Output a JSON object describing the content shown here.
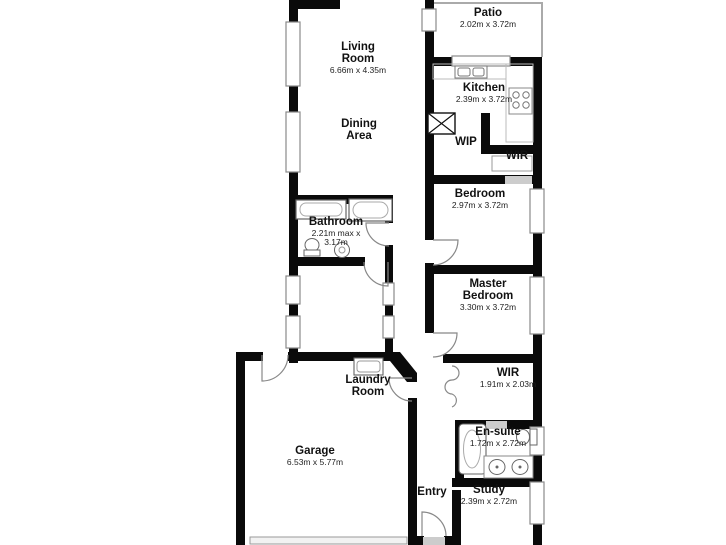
{
  "plan": {
    "type": "floor-plan",
    "wall_color": "#000000",
    "window_frame_color": "#8a8a8a",
    "opening_color": "#cccccc",
    "fixture_line_color": "#777777",
    "background_color": "#ffffff",
    "rooms": [
      {
        "name": "Living Room",
        "dims": "6.66m x 4.35m"
      },
      {
        "name": "Patio",
        "dims": "2.02m x 3.72m"
      },
      {
        "name": "Kitchen",
        "dims": "2.39m x 3.72m"
      },
      {
        "name": "Dining Area",
        "dims": ""
      },
      {
        "name": "WIP",
        "dims": ""
      },
      {
        "name": "WIR",
        "dims": ""
      },
      {
        "name": "Bedroom",
        "dims": "2.97m x 3.72m"
      },
      {
        "name": "Bathroom",
        "dims": "2.21m max x 3.17m"
      },
      {
        "name": "Master Bedroom",
        "dims": "3.30m x 3.72m"
      },
      {
        "name": "WIR",
        "dims": "1.91m x 2.03m"
      },
      {
        "name": "Laundry Room",
        "dims": ""
      },
      {
        "name": "Garage",
        "dims": "6.53m x 5.77m"
      },
      {
        "name": "Entry",
        "dims": ""
      },
      {
        "name": "En-suite",
        "dims": "1.72m x 2.72m"
      },
      {
        "name": "Study",
        "dims": "2.39m x 2.72m"
      }
    ]
  }
}
